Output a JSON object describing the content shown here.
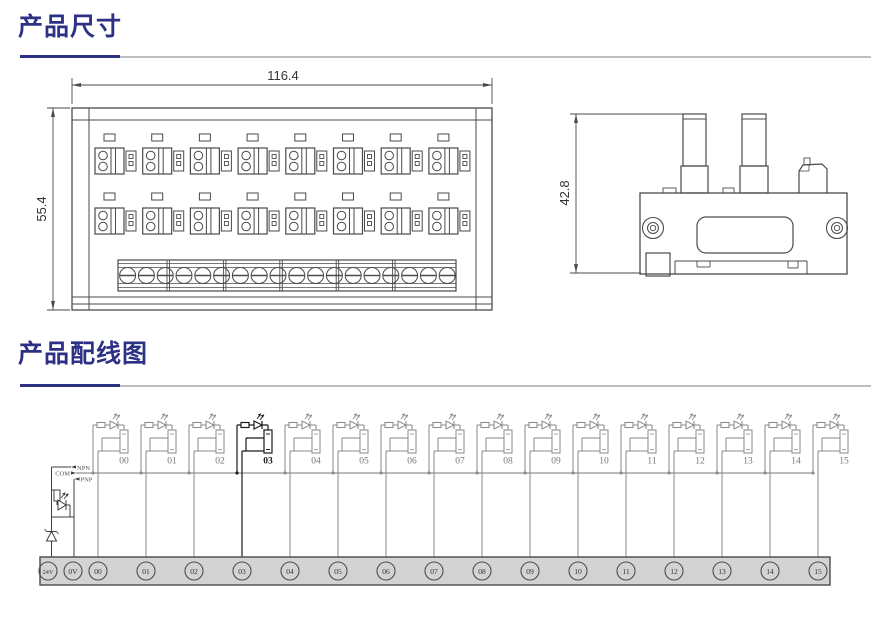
{
  "sections": [
    {
      "title": "产品尺寸"
    },
    {
      "title": "产品配线图"
    }
  ],
  "colors": {
    "accent": "#2d3186",
    "rule_gray": "#bdbdbd",
    "line_dark": "#4a4a4a",
    "line_gray": "#8a8a8a",
    "highlight_line": "#1a1a1a",
    "bar_fill": "#d3d3d3",
    "dim_text": "#333333",
    "small_text": "#555555"
  },
  "front_view": {
    "width_label": "116.4",
    "height_label": "55.4",
    "relay_rows": 2,
    "relays_per_row": 8,
    "terminal_count": 18
  },
  "side_view": {
    "height_label": "42.8"
  },
  "wiring": {
    "selector_labels": [
      "NPN",
      "COM",
      "PNP"
    ],
    "channel_labels": [
      "00",
      "01",
      "02",
      "03",
      "04",
      "05",
      "06",
      "07",
      "08",
      "09",
      "10",
      "11",
      "12",
      "13",
      "14",
      "15"
    ],
    "highlighted_channel": "03",
    "terminal_labels": [
      "24V",
      "0V",
      "00",
      "01",
      "02",
      "03",
      "04",
      "05",
      "06",
      "07",
      "08",
      "09",
      "10",
      "11",
      "12",
      "13",
      "14",
      "15"
    ]
  }
}
